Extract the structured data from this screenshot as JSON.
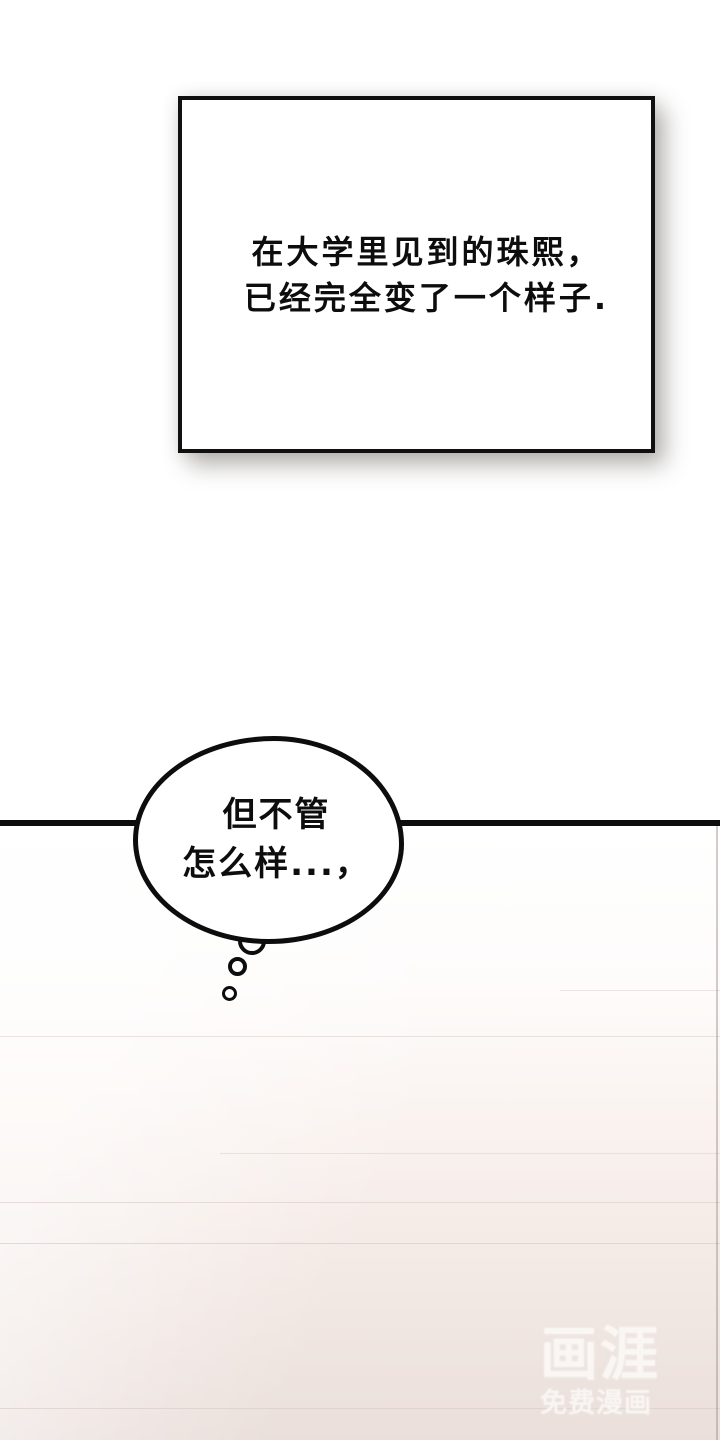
{
  "caption_box": {
    "lines": [
      "在大学里见到的珠熙，",
      "已经完全变了一个样子."
    ]
  },
  "thought_bubble": {
    "lines": [
      "但不管",
      "怎么样...，"
    ]
  },
  "watermark": {
    "logo": "画涯",
    "tagline": "免费漫画"
  },
  "colors": {
    "ink": "#0d0d0d",
    "page_bg": "#ffffff",
    "bottom_bg_pink": "#eadfdb",
    "faint_line": "#d9cec9",
    "watermark_text": "rgba(251,248,246,0.85)"
  }
}
